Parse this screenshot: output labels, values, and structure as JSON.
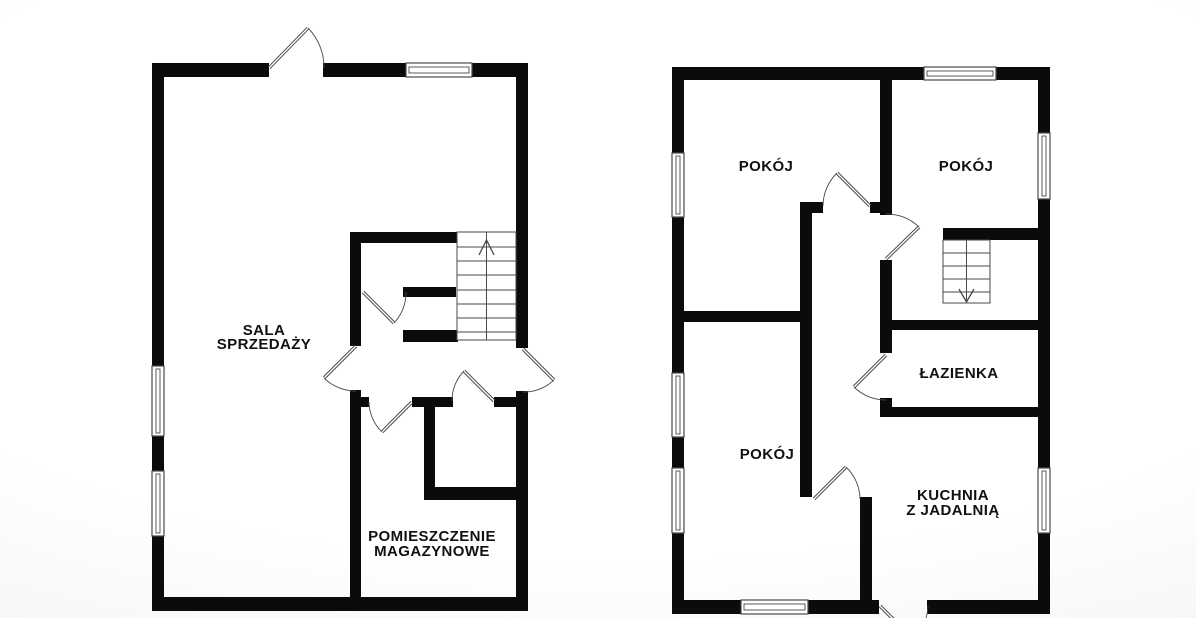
{
  "canvas": {
    "width": 1196,
    "height": 618,
    "background": "#ffffff",
    "wall_color": "#0b0b0b",
    "line_color": "#4a4a4a",
    "text_color": "#111111"
  },
  "plans": [
    {
      "id": "left-floor-plan",
      "rooms": [
        {
          "name": "sala-sprzedazy",
          "lines": [
            "SALA",
            "SPRZEDAŻY"
          ],
          "x": 264,
          "y": 335,
          "lh": 14
        },
        {
          "name": "pomieszczenie-magazynowe",
          "lines": [
            "POMIESZCZENIE",
            "MAGAZYNOWE"
          ],
          "x": 432,
          "y": 541,
          "lh": 15
        }
      ],
      "walls": [
        [
          152,
          63,
          117,
          14
        ],
        [
          323,
          63,
          83,
          14
        ],
        [
          472,
          63,
          56,
          14
        ],
        [
          152,
          63,
          12,
          303
        ],
        [
          152,
          436,
          12,
          35
        ],
        [
          152,
          536,
          12,
          75
        ],
        [
          152,
          597,
          376,
          14
        ],
        [
          516,
          63,
          12,
          285
        ],
        [
          516,
          391,
          12,
          220
        ],
        [
          350,
          232,
          11,
          114
        ],
        [
          350,
          390,
          11,
          207
        ],
        [
          350,
          232,
          108,
          11
        ],
        [
          403,
          287,
          53,
          10
        ],
        [
          403,
          330,
          55,
          12
        ],
        [
          424,
          397,
          11,
          97
        ],
        [
          424,
          487,
          93,
          13
        ],
        [
          350,
          397,
          19,
          10
        ],
        [
          412,
          397,
          41,
          10
        ],
        [
          494,
          397,
          22,
          10
        ]
      ],
      "windows": [
        {
          "x": 406,
          "y": 63,
          "w": 66,
          "h": 14
        },
        {
          "x": 152,
          "y": 366,
          "w": 12,
          "h": 70
        },
        {
          "x": 152,
          "y": 471,
          "w": 12,
          "h": 65
        }
      ],
      "doors": [
        {
          "hinge": [
            269,
            68
          ],
          "open": [
            308,
            28
          ],
          "closed": [
            324,
            68
          ],
          "sweep": 1
        },
        {
          "hinge": [
            356,
            346
          ],
          "open": [
            324,
            378
          ],
          "closed": [
            356,
            391
          ],
          "sweep": 0
        },
        {
          "hinge": [
            363,
            292
          ],
          "open": [
            394,
            323
          ],
          "closed": [
            406,
            292
          ],
          "sweep": 0
        },
        {
          "hinge": [
            494,
            401
          ],
          "open": [
            464,
            371
          ],
          "closed": [
            452,
            401
          ],
          "sweep": 0
        },
        {
          "hinge": [
            412,
            402
          ],
          "open": [
            382,
            432
          ],
          "closed": [
            369,
            402
          ],
          "sweep": 1
        },
        {
          "hinge": [
            523,
            349
          ],
          "open": [
            554,
            380
          ],
          "closed": [
            523,
            392
          ],
          "sweep": 1
        }
      ],
      "stairs": {
        "x": 457,
        "y": 232,
        "w": 59,
        "h": 108,
        "treads": [
          247,
          261,
          275,
          290,
          304,
          318,
          332
        ],
        "direction": "up",
        "arrow": {
          "tip": [
            486.5,
            240
          ],
          "left": [
            479,
            255
          ],
          "right": [
            494,
            255
          ]
        }
      }
    },
    {
      "id": "right-floor-plan",
      "rooms": [
        {
          "name": "pokoj-top-left",
          "lines": [
            "POKÓJ"
          ],
          "x": 766,
          "y": 171,
          "lh": 15
        },
        {
          "name": "pokoj-top-right",
          "lines": [
            "POKÓJ"
          ],
          "x": 966,
          "y": 171,
          "lh": 15
        },
        {
          "name": "lazienka",
          "lines": [
            "ŁAZIENKA"
          ],
          "x": 959,
          "y": 378,
          "lh": 15
        },
        {
          "name": "pokoj-bottom-left",
          "lines": [
            "POKÓJ"
          ],
          "x": 767,
          "y": 459,
          "lh": 15
        },
        {
          "name": "kuchnia-z-jadalnia",
          "lines": [
            "KUCHNIA",
            "Z JADALNIĄ"
          ],
          "x": 953,
          "y": 500,
          "lh": 15
        }
      ],
      "walls": [
        [
          672,
          67,
          252,
          13
        ],
        [
          996,
          67,
          54,
          13
        ],
        [
          672,
          67,
          12,
          86
        ],
        [
          672,
          217,
          12,
          156
        ],
        [
          672,
          437,
          12,
          31
        ],
        [
          672,
          533,
          12,
          81
        ],
        [
          672,
          600,
          69,
          14
        ],
        [
          808,
          600,
          71,
          14
        ],
        [
          927,
          600,
          123,
          14
        ],
        [
          1038,
          67,
          12,
          66
        ],
        [
          1038,
          199,
          12,
          269
        ],
        [
          1038,
          533,
          12,
          81
        ],
        [
          880,
          67,
          12,
          148
        ],
        [
          880,
          260,
          12,
          93
        ],
        [
          880,
          398,
          12,
          19
        ],
        [
          800,
          202,
          23,
          11
        ],
        [
          870,
          202,
          22,
          11
        ],
        [
          800,
          202,
          12,
          295
        ],
        [
          684,
          311,
          116,
          11
        ],
        [
          943,
          228,
          107,
          12
        ],
        [
          880,
          320,
          170,
          10
        ],
        [
          880,
          407,
          170,
          10
        ],
        [
          860,
          497,
          12,
          105
        ]
      ],
      "windows": [
        {
          "x": 924,
          "y": 67,
          "w": 72,
          "h": 13
        },
        {
          "x": 741,
          "y": 600,
          "w": 67,
          "h": 14
        },
        {
          "x": 672,
          "y": 153,
          "w": 12,
          "h": 64
        },
        {
          "x": 672,
          "y": 373,
          "w": 12,
          "h": 64
        },
        {
          "x": 672,
          "y": 468,
          "w": 12,
          "h": 65
        },
        {
          "x": 1038,
          "y": 133,
          "w": 12,
          "h": 66
        },
        {
          "x": 1038,
          "y": 468,
          "w": 12,
          "h": 65
        }
      ],
      "doors": [
        {
          "hinge": [
            870,
            206
          ],
          "open": [
            837,
            173
          ],
          "closed": [
            823,
            206
          ],
          "sweep": 0
        },
        {
          "hinge": [
            886,
            259
          ],
          "open": [
            919,
            227
          ],
          "closed": [
            886,
            214
          ],
          "sweep": 0
        },
        {
          "hinge": [
            886,
            355
          ],
          "open": [
            854,
            387
          ],
          "closed": [
            886,
            400
          ],
          "sweep": 0
        },
        {
          "hinge": [
            814,
            499
          ],
          "open": [
            846,
            467
          ],
          "closed": [
            860,
            499
          ],
          "sweep": 1
        },
        {
          "hinge": [
            880,
            606
          ],
          "open": [
            913,
            639
          ],
          "closed": [
            928,
            606
          ],
          "sweep": 0
        }
      ],
      "stairs": {
        "x": 943,
        "y": 240,
        "w": 47,
        "h": 63,
        "treads": [
          253,
          266,
          279,
          292
        ],
        "direction": "down",
        "arrow": {
          "tip": [
            966.5,
            302
          ],
          "left": [
            959,
            289
          ],
          "right": [
            974,
            289
          ]
        }
      }
    }
  ]
}
